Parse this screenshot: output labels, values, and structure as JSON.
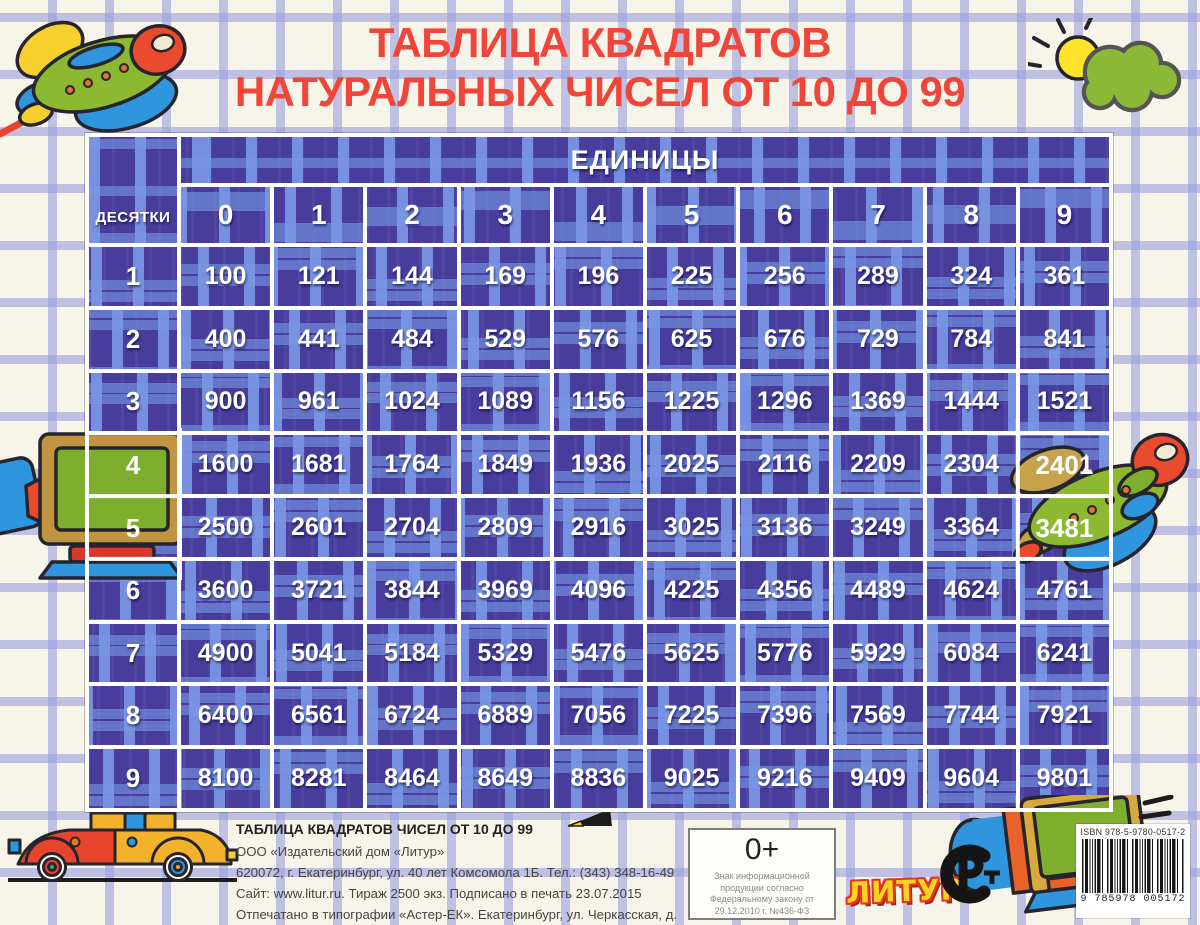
{
  "poster": {
    "title_line1": "ТАБЛИЦА КВАДРАТОВ",
    "title_line2": "НАТУРАЛЬНЫХ ЧИСЕЛ ОТ 10 ДО 99"
  },
  "table": {
    "corner_label": "ДЕСЯТКИ",
    "units_label": "ЕДИНИЦЫ",
    "col_headers": [
      "0",
      "1",
      "2",
      "3",
      "4",
      "5",
      "6",
      "7",
      "8",
      "9"
    ],
    "row_headers": [
      "1",
      "2",
      "3",
      "4",
      "5",
      "6",
      "7",
      "8",
      "9"
    ],
    "values": [
      [
        100,
        121,
        144,
        169,
        196,
        225,
        256,
        289,
        324,
        361
      ],
      [
        400,
        441,
        484,
        529,
        576,
        625,
        676,
        729,
        784,
        841
      ],
      [
        900,
        961,
        1024,
        1089,
        1156,
        1225,
        1296,
        1369,
        1444,
        1521
      ],
      [
        1600,
        1681,
        1764,
        1849,
        1936,
        2025,
        2116,
        2209,
        2304,
        2401
      ],
      [
        2500,
        2601,
        2704,
        2809,
        2916,
        3025,
        3136,
        3249,
        3364,
        3481
      ],
      [
        3600,
        3721,
        3844,
        3969,
        4096,
        4225,
        4356,
        4489,
        4624,
        4761
      ],
      [
        4900,
        5041,
        5184,
        5329,
        5476,
        5625,
        5776,
        5929,
        6084,
        6241
      ],
      [
        6400,
        6561,
        6724,
        6889,
        7056,
        7225,
        7396,
        7569,
        7744,
        7921
      ],
      [
        8100,
        8281,
        8464,
        8649,
        8836,
        9025,
        9216,
        9409,
        9604,
        9801
      ]
    ],
    "overlay_digits": {
      "row4_header": "4",
      "row5_header": "5",
      "cell_49": "2401",
      "cell_59": "3481",
      "cell_99": "9801"
    }
  },
  "footer": {
    "imprint_title": "ТАБЛИЦА КВАДРАТОВ ЧИСЕЛ ОТ 10 ДО 99",
    "imprint_lines": [
      "ООО «Издательский дом «Литур»",
      "620072, г. Екатеринбург, ул. 40 лет Комсомола 1Б. Тел.: (343) 348-16-49",
      "Сайт: www.litur.ru. Тираж 2500 экз. Подписано в печать 23.07.2015",
      "Отпечатано в типографии «Астер-ЕК». Екатеринбург, ул. Черкасская, д. 10ф"
    ],
    "age_mark": "0+",
    "age_note_lines": [
      "Знак  информационной",
      "продукции согласно",
      "Федеральному закону от",
      "29.12.2010 г.  №436-ФЗ"
    ],
    "publisher_logo": "ЛИТУР",
    "isbn": "ISBN 978-5-9780-0517-2",
    "barcode_digits": "9 785978 005172"
  },
  "decorations": [
    "airplane-top-left",
    "sun-cloud-top-right",
    "tv-set-left",
    "airplane-right",
    "car-bottom-left",
    "pencil-tip",
    "tv-set-bottom-right",
    "rst-certification-mark",
    "road-line",
    "sketch-grid-background"
  ],
  "colors": {
    "title_red": "#f1453a",
    "plaid_base": "#483c9c",
    "plaid_stripe": "#7a96e4",
    "cell_border": "#ffffff",
    "page_background": "#f7f4ea",
    "sketch_grid": "#9a9edd",
    "logo_yellow": "#ffd21f",
    "logo_outline_red": "#e03426"
  }
}
